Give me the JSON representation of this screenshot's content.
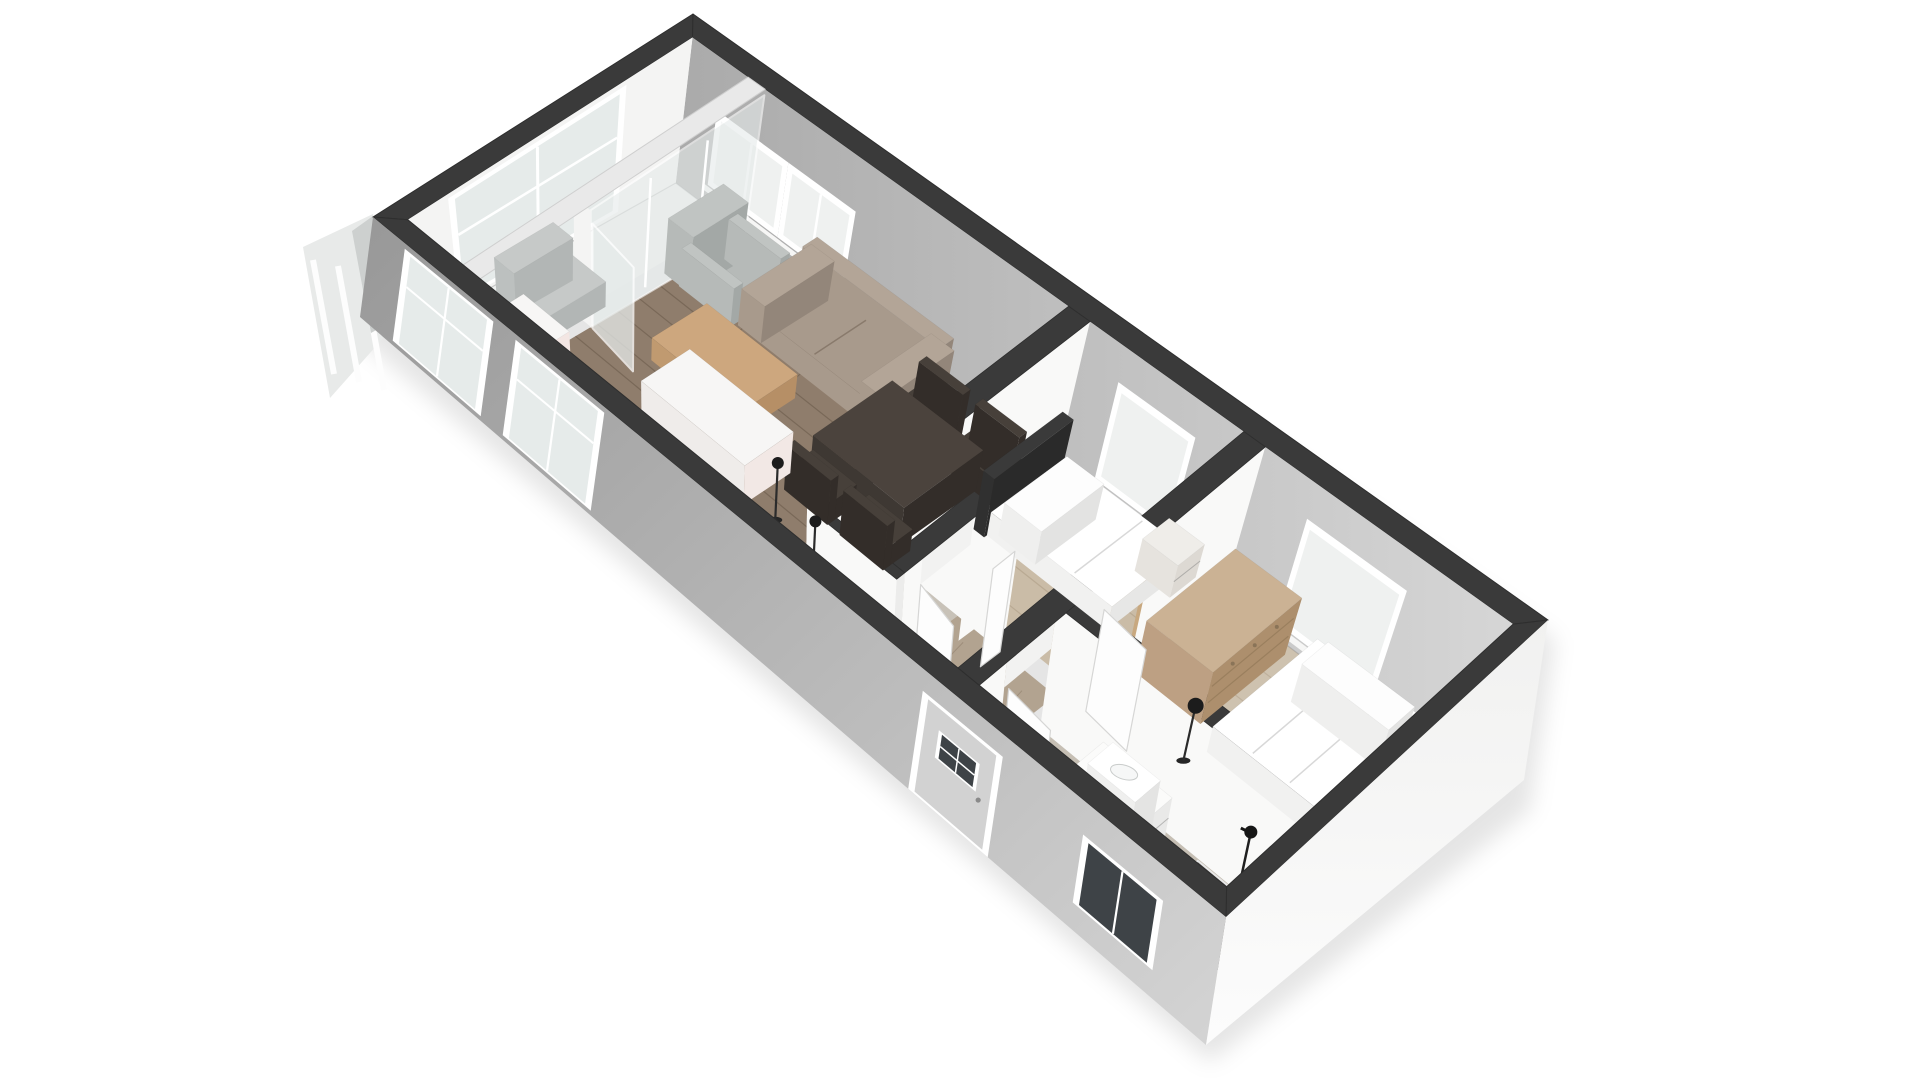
{
  "scene": {
    "label": "3D isometric floor plan of a small apartment with living room, two bedrooms, hallway and bathroom",
    "width": 1920,
    "height": 1080,
    "background": "#ffffff"
  },
  "colors": {
    "wallTop": "#3a3a3a",
    "wallStroke": "#2e2e2e",
    "faceWhite": "#f9f9f8",
    "faceEnd": "#ececeb",
    "lintel": "#f2f2f1",
    "nwFace": "#f4f4f3",
    "neFrom": "#aaaaaa",
    "neTo": "#d6d6d6",
    "extSWFrom": "#989898",
    "extSWTo": "#d4d4d4",
    "extSEFrom": "#f1f1f0",
    "extSETo": "#fcfcfc",
    "frame": "#ffffff",
    "glassLight": "#e6ebea",
    "glassDark": "#3e4347",
    "sliver": "#e8eae9",
    "shadow": "rgba(0,0,0,0.10)",
    "jamb": "#c8a87f",
    "thresholdWood": "#9c7d59",
    "doormat": "#6a6156",
    "floorJunction": "rgba(120,120,120,0.55)"
  },
  "rooms": [
    {
      "name": "balcony-floor",
      "u": [
        0.02,
        0.085
      ],
      "v": [
        0.055,
        0.945
      ],
      "fill": "#eef0ef"
    },
    {
      "name": "living-room-floor",
      "u": [
        0.105,
        0.46
      ],
      "v": [
        0.055,
        0.945
      ],
      "fill": "#8f7d6c",
      "planks": {
        "dv": 0.075,
        "col": "rgba(56,42,28,0.25)"
      }
    },
    {
      "name": "bedroom-1-floor",
      "u": [
        0.485,
        0.665
      ],
      "v": [
        0.055,
        0.52
      ],
      "fill": "#cabca7",
      "planks": {
        "dv": 0.1,
        "col": "rgba(110,90,60,0.18)"
      }
    },
    {
      "name": "hallway-floor",
      "u": [
        0.545,
        0.665
      ],
      "v": [
        0.575,
        0.945
      ],
      "fill": "#b2a390",
      "planks": {
        "dv": 0.12,
        "col": "rgba(80,62,42,0.2)"
      }
    },
    {
      "name": "hallway-floor-entry",
      "u": [
        0.48,
        0.545
      ],
      "v": [
        0.87,
        0.945
      ],
      "fill": "#b2a390"
    },
    {
      "name": "closet-floor",
      "u": [
        0.48,
        0.545
      ],
      "v": [
        0.575,
        0.845
      ],
      "fill": "#c8c2b8"
    },
    {
      "name": "bedroom-2-floor",
      "u": [
        0.69,
        0.98
      ],
      "v": [
        0.055,
        0.62
      ],
      "fill": "#cec2af",
      "planks": {
        "dv": 0.1,
        "col": "rgba(110,90,60,0.16)"
      }
    },
    {
      "name": "bathroom-floor",
      "u": [
        0.69,
        0.98
      ],
      "v": [
        0.675,
        0.945
      ],
      "fill": "#c6bfb4"
    },
    {
      "name": "shower-tray",
      "u": [
        0.875,
        0.975
      ],
      "v": [
        0.68,
        0.875
      ],
      "fill": "#57534f",
      "rim": "#e8e8e8"
    },
    {
      "name": "entry-doormat",
      "u": [
        0.55,
        0.645
      ],
      "v": [
        0.88,
        0.945
      ],
      "fill": "#6a6156"
    }
  ],
  "glass_partition": {
    "u": [
      0.085,
      0.105
    ],
    "v": [
      0.055,
      0.945
    ],
    "paneEnd": 0.6,
    "bandFill": "#e9e9e9",
    "mullions": [
      0.23,
      0.41
    ],
    "leaf": {
      "a": [
        0.107,
        0.6
      ],
      "b": [
        0.165,
        0.625
      ],
      "z": 0.86
    }
  },
  "walls": [
    {
      "name": "wall-living-bedroom1",
      "axis": "b",
      "u": [
        0.46,
        0.485
      ],
      "v": [
        0.055,
        0.575
      ]
    },
    {
      "name": "wall-bedroom1-bedroom2",
      "axis": "b",
      "u": [
        0.665,
        0.69
      ],
      "v": [
        0.055,
        0.575
      ],
      "open": [
        0.4,
        0.555
      ],
      "jamb": true,
      "threshold": true
    },
    {
      "name": "wall-bedroom1-hall",
      "axis": "a",
      "u": [
        0.46,
        0.665
      ],
      "v": [
        0.52,
        0.575
      ],
      "open": [
        0.6,
        0.655
      ]
    },
    {
      "name": "wall-closet-left",
      "axis": "b",
      "u": [
        0.46,
        0.48
      ],
      "v": [
        0.575,
        0.87
      ]
    },
    {
      "name": "wall-closet-right",
      "axis": "b",
      "u": [
        0.545,
        0.565
      ],
      "v": [
        0.575,
        0.845
      ],
      "open": [
        0.63,
        0.79
      ]
    },
    {
      "name": "wall-closet-front",
      "axis": "a",
      "u": [
        0.46,
        0.565
      ],
      "v": [
        0.845,
        0.87
      ]
    },
    {
      "name": "wall-hall-bathroom",
      "axis": "b",
      "u": [
        0.665,
        0.69
      ],
      "v": [
        0.575,
        0.945
      ],
      "open": [
        0.71,
        0.86
      ]
    },
    {
      "name": "wall-bedroom2-bathroom",
      "axis": "a",
      "u": [
        0.69,
        0.98
      ],
      "v": [
        0.62,
        0.675
      ]
    }
  ],
  "ne_windows": [
    {
      "name": "living-window-1",
      "u": [
        0.062,
        0.135
      ],
      "z": [
        0.18,
        0.6
      ],
      "mullion": true
    },
    {
      "name": "living-window-2",
      "u": [
        0.147,
        0.215
      ],
      "z": [
        0.18,
        0.6
      ],
      "mullion": true
    },
    {
      "name": "bedroom1-window",
      "u": [
        0.534,
        0.613
      ],
      "z": [
        0.16,
        0.72
      ],
      "mullion": false
    },
    {
      "name": "bedroom2-window",
      "u": [
        0.757,
        0.863
      ],
      "z": [
        0.12,
        0.72
      ],
      "mullion": false
    }
  ],
  "nw_window": {
    "name": "end-wall-window",
    "v": [
      0.28,
      0.8
    ],
    "z": [
      0.06,
      0.92
    ],
    "mullion": 0.54,
    "transom": 0.6
  },
  "exterior_sw": [
    {
      "type": "window",
      "name": "balcony-window-1",
      "f": [
        0.045,
        0.135
      ],
      "z": [
        0.06,
        0.92
      ],
      "glass": "light",
      "transom": 0.62
    },
    {
      "type": "window",
      "name": "balcony-window-2",
      "f": [
        0.175,
        0.265
      ],
      "z": [
        0.06,
        0.92
      ],
      "glass": "light",
      "transom": 0.62
    },
    {
      "type": "door",
      "name": "front-door",
      "f": [
        0.655,
        0.735
      ],
      "z": [
        0.02,
        0.8
      ],
      "fill": "#d2d2d2",
      "win": {
        "f": [
          0.675,
          0.715
        ],
        "z": [
          0.42,
          0.62
        ]
      }
    },
    {
      "type": "window",
      "name": "bathroom-window",
      "f": [
        0.845,
        0.925
      ],
      "z": [
        0.22,
        0.72
      ],
      "glass": "dark"
    }
  ],
  "furniture": [
    {
      "type": "box",
      "name": "balcony-chair",
      "u": [
        0.035,
        0.095
      ],
      "v": [
        0.52,
        0.72
      ],
      "z": 0.2,
      "top": "#c6c9c8",
      "se": "#b2b6b5",
      "sw": "#bcc0bf",
      "back": {
        "side": "u1",
        "z": 0.34
      }
    },
    {
      "type": "armchair",
      "name": "armchair",
      "u": [
        0.1,
        0.178
      ],
      "v": [
        0.13,
        0.315
      ],
      "body": "#b6bab8",
      "dark": "#a3a8a6",
      "light": "#c0c4c2"
    },
    {
      "type": "sofa",
      "name": "sofa",
      "u": [
        0.185,
        0.35
      ],
      "v": [
        0.062,
        0.3
      ],
      "body": "#a89a8c",
      "dark": "#93867a",
      "light": "#b3a597"
    },
    {
      "type": "box",
      "name": "coffee-table",
      "u": [
        0.165,
        0.275
      ],
      "v": [
        0.37,
        0.56
      ],
      "z": 0.18,
      "top": "#cda77e",
      "se": "#b68f66",
      "sw": "#c09a70"
    },
    {
      "type": "chair",
      "name": "dining-chair-1",
      "u": [
        0.352,
        0.405
      ],
      "v": [
        0.165,
        0.255
      ],
      "dir": "nw",
      "cTop": "#47403a",
      "cSide": "#332d29"
    },
    {
      "type": "chair",
      "name": "dining-chair-2",
      "u": [
        0.42,
        0.473
      ],
      "v": [
        0.165,
        0.255
      ],
      "dir": "nw",
      "cTop": "#47403a",
      "cSide": "#332d29"
    },
    {
      "type": "box",
      "name": "dining-table",
      "u": [
        0.345,
        0.455
      ],
      "v": [
        0.25,
        0.52
      ],
      "z": 0.29,
      "top": "#4b433d",
      "se": "#332d29",
      "sw": "#3e3833"
    },
    {
      "type": "chair",
      "name": "dining-chair-3",
      "u": [
        0.345,
        0.398
      ],
      "v": [
        0.515,
        0.605
      ],
      "dir": "se",
      "cTop": "#47403a",
      "cSide": "#332d29"
    },
    {
      "type": "chair",
      "name": "dining-chair-4",
      "u": [
        0.413,
        0.466
      ],
      "v": [
        0.515,
        0.605
      ],
      "dir": "se",
      "cTop": "#47403a",
      "cSide": "#332d29"
    },
    {
      "type": "box",
      "name": "tall-cabinet",
      "u": [
        0.085,
        0.14
      ],
      "v": [
        0.77,
        0.93
      ],
      "z": 0.42,
      "top": "#f7f6f5",
      "se": "#f3e6e3",
      "sw": "#efeceb"
    },
    {
      "type": "box",
      "name": "sideboard",
      "u": [
        0.21,
        0.335
      ],
      "v": [
        0.56,
        0.725
      ],
      "z": 0.33,
      "top": "#f7f6f5",
      "se": "#f2e8e5",
      "sw": "#efecea"
    },
    {
      "type": "lamp",
      "name": "floor-lamp-1",
      "u": 0.365,
      "v": 0.7,
      "h": 0.48,
      "r": 6
    },
    {
      "type": "lamp",
      "name": "floor-lamp-2",
      "u": 0.43,
      "v": 0.755,
      "h": 0.46,
      "r": 6
    },
    {
      "type": "box",
      "name": "bed1-headboard",
      "u": [
        0.485,
        0.498
      ],
      "v": [
        0.08,
        0.345
      ],
      "z": 0.43,
      "top": "#3a3a3a",
      "se": "#2a2a2a",
      "sw": "#303030"
    },
    {
      "type": "bed",
      "name": "bed-single",
      "u": [
        0.498,
        0.645
      ],
      "v": [
        0.08,
        0.335
      ],
      "z": 0.17,
      "pillow": {
        "u": [
          0.505,
          0.55
        ],
        "v": [
          0.1,
          0.315
        ],
        "z": 0.24
      }
    },
    {
      "type": "box",
      "name": "nightstand",
      "u": [
        0.615,
        0.658
      ],
      "v": [
        0.058,
        0.15
      ],
      "z": 0.22,
      "top": "#efede9",
      "se": "#ddd9d3",
      "sw": "#e6e3de",
      "seam": true
    },
    {
      "type": "dresser",
      "name": "dresser",
      "u": [
        0.695,
        0.775
      ],
      "v": [
        0.08,
        0.38
      ],
      "z": 0.38,
      "top": "#cbb294",
      "se": "#ad8f6d",
      "sw": "#bda083"
    },
    {
      "type": "lamp",
      "name": "bedroom2-floor-lamp",
      "u": 0.792,
      "v": 0.49,
      "h": 0.42,
      "r": 8
    },
    {
      "type": "bed",
      "name": "bed-double",
      "u": [
        0.8,
        0.935
      ],
      "v": [
        0.068,
        0.43
      ],
      "z": 0.19,
      "pillow": {
        "u": [
          0.815,
          0.92
        ],
        "v": [
          0.085,
          0.175
        ],
        "z": 0.26
      }
    },
    {
      "type": "box",
      "name": "bathroom-vanity",
      "u": [
        0.755,
        0.838
      ],
      "v": [
        0.69,
        0.818
      ],
      "z": 0.33,
      "top": "#fbfbfa",
      "se": "#e9e9e8",
      "sw": "#f1f1f0",
      "seam": true
    },
    {
      "type": "basin",
      "name": "wash-basin",
      "u": [
        0.768,
        0.825
      ],
      "v": [
        0.7,
        0.785
      ],
      "z": 0.42
    },
    {
      "type": "shower",
      "name": "shower-fixture",
      "u": 0.925,
      "v": 0.685
    }
  ],
  "door_leaves": [
    {
      "name": "bedroom1-door-leaf",
      "a": [
        0.598,
        0.578
      ],
      "b": [
        0.598,
        0.648
      ],
      "z": 0.8
    },
    {
      "name": "closet-door-leaf",
      "a": [
        0.567,
        0.795
      ],
      "b": [
        0.617,
        0.825
      ],
      "z": 0.8
    },
    {
      "name": "bathroom-door-leaf",
      "a": [
        0.695,
        0.86
      ],
      "b": [
        0.75,
        0.875
      ],
      "z": 0.8
    },
    {
      "name": "bedroom2-door-leaf",
      "a": [
        0.695,
        0.555
      ],
      "b": [
        0.75,
        0.57
      ],
      "z": 0.8
    }
  ]
}
